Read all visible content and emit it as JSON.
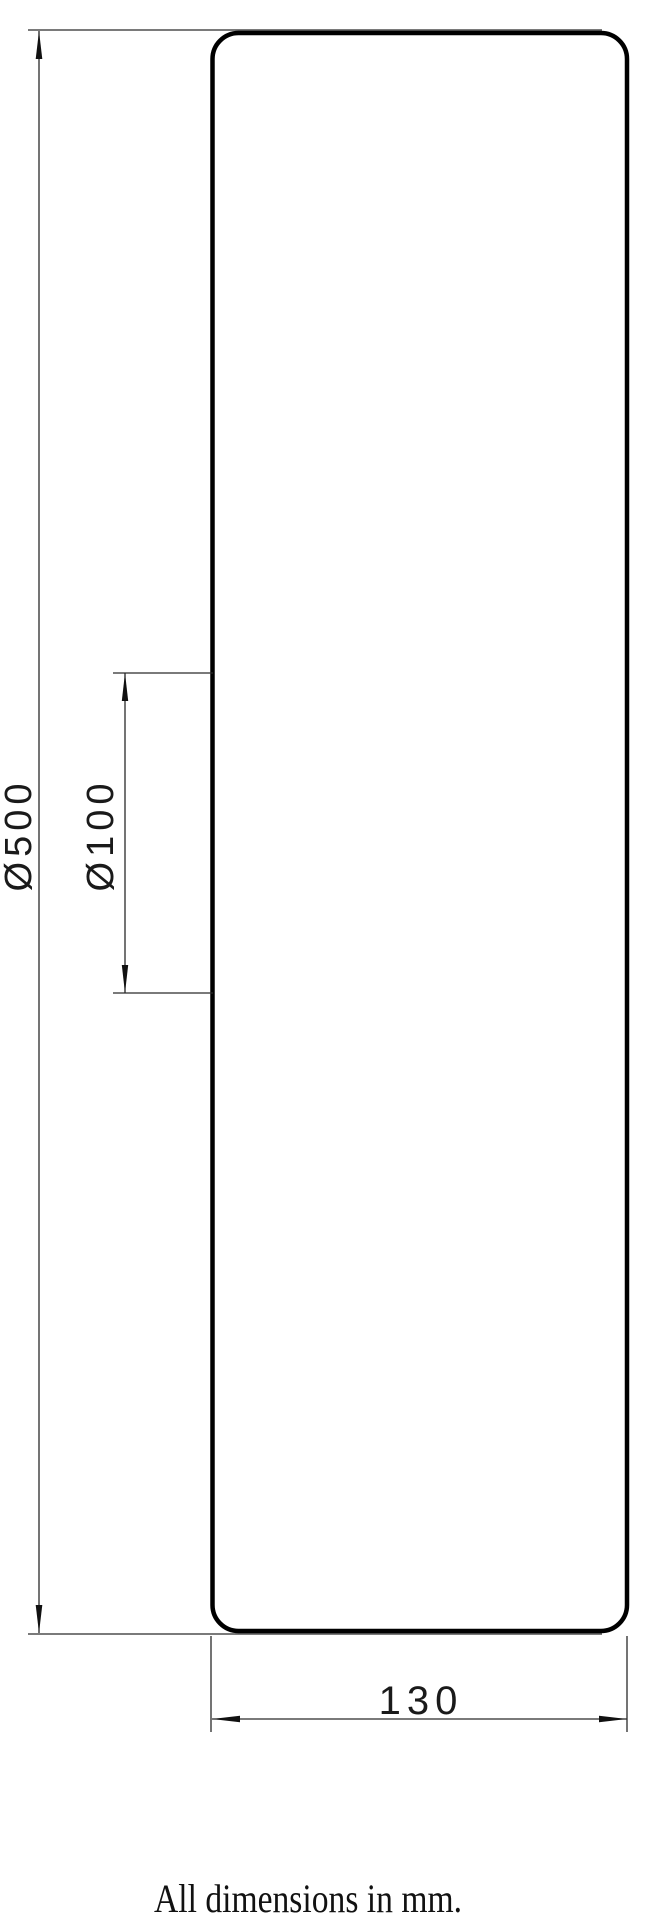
{
  "drawing": {
    "view": "side-view-of-cylindrical-part",
    "colors": {
      "background": "#ffffff",
      "outline": "#000000",
      "dimension_lines": "#2a2a2a",
      "text": "#1a1a1a"
    },
    "dimensions": [
      {
        "id": "overall-diameter",
        "label": "Ø500",
        "value": 500
      },
      {
        "id": "inner-diameter",
        "label": "Ø100",
        "value": 100
      },
      {
        "id": "thickness",
        "label": "130",
        "value": 130
      }
    ],
    "note": "All dimensions in mm."
  }
}
